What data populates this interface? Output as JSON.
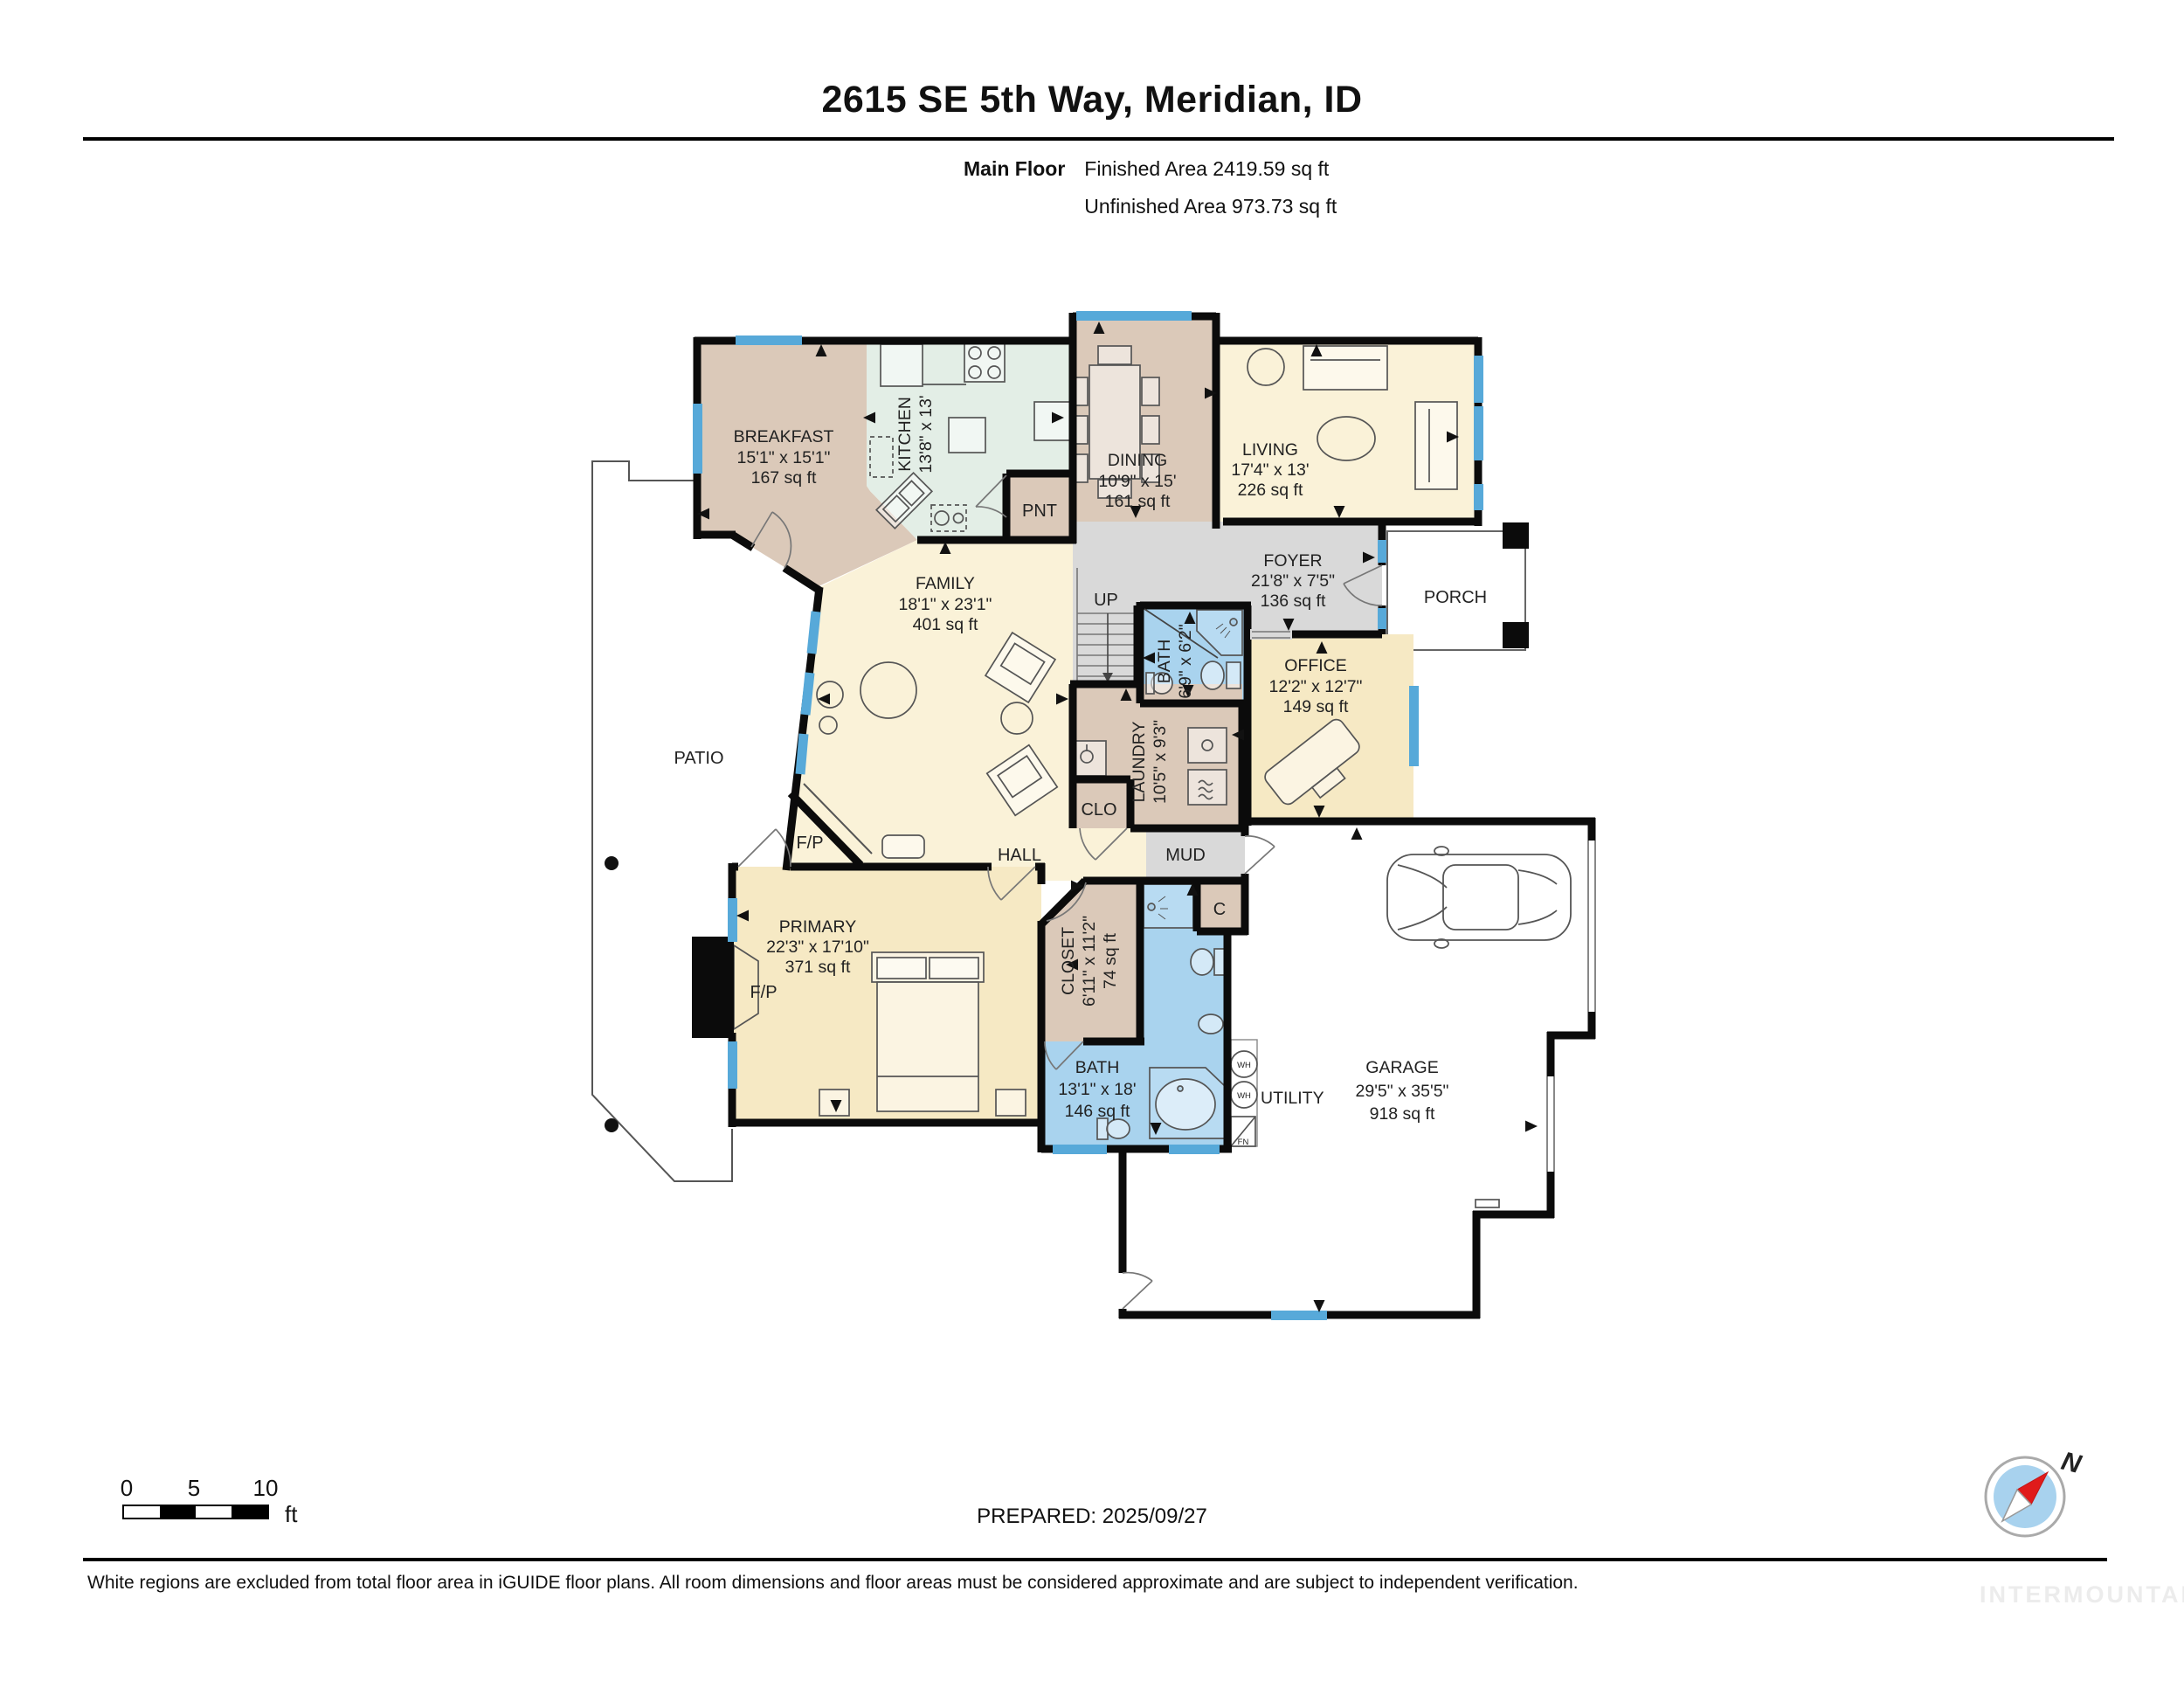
{
  "header": {
    "title": "2615 SE 5th Way, Meridian, ID",
    "floor_label": "Main Floor",
    "finished": "Finished Area 2419.59 sq ft",
    "unfinished": "Unfinished Area 973.73 sq ft"
  },
  "rooms": {
    "breakfast": {
      "name": "BREAKFAST",
      "dims": "15'1\" x 15'1\"",
      "area": "167 sq ft"
    },
    "kitchen": {
      "name": "KITCHEN",
      "dims": "13'8\" x 13'"
    },
    "pantry": {
      "name": "PNT"
    },
    "dining": {
      "name": "DINING",
      "dims": "10'9\" x 15'",
      "area": "161 sq ft"
    },
    "living": {
      "name": "LIVING",
      "dims": "17'4\" x 13'",
      "area": "226 sq ft"
    },
    "foyer": {
      "name": "FOYER",
      "dims": "21'8\" x 7'5\"",
      "area": "136 sq ft"
    },
    "porch": {
      "name": "PORCH"
    },
    "family": {
      "name": "FAMILY",
      "dims": "18'1\" x 23'1\"",
      "area": "401 sq ft"
    },
    "stairs_label": "UP",
    "half_bath": {
      "name": "BATH",
      "dims": "6'9\" x 6'2\""
    },
    "office": {
      "name": "OFFICE",
      "dims": "12'2\" x 12'7\"",
      "area": "149 sq ft"
    },
    "laundry": {
      "name": "LAUNDRY",
      "dims": "10'5\" x 9'3\""
    },
    "hall_closet": "CLO",
    "hall": "HALL",
    "mud": "MUD",
    "patio": "PATIO",
    "primary": {
      "name": "PRIMARY",
      "dims": "22'3\" x 17'10\"",
      "area": "371 sq ft"
    },
    "closet": {
      "name": "CLOSET",
      "dims": "6'11\" x 11'2\"",
      "area": "74 sq ft"
    },
    "closet_c": "C",
    "primary_bath": {
      "name": "BATH",
      "dims": "13'1\" x 18'",
      "area": "146 sq ft"
    },
    "utility": "UTILITY",
    "garage": {
      "name": "GARAGE",
      "dims": "29'5\" x 35'5\"",
      "area": "918 sq ft"
    },
    "fireplace": "F/P",
    "water_heater": "WH",
    "furnace": "FN"
  },
  "scale": {
    "n0": "0",
    "n5": "5",
    "n10": "10",
    "unit": "ft"
  },
  "compass": {
    "north": "N"
  },
  "footer": {
    "prepared": "PREPARED: 2025/09/27",
    "disclaimer": "White regions are excluded from total floor area in iGUIDE floor plans. All room dimensions and floor areas must be considered approximate and are subject to independent verification.",
    "watermark": "INTERMOUNTAIN"
  },
  "colors": {
    "tan_room": "#dbc9b9",
    "mint_room": "#e3eee6",
    "cream_room": "#faf2d8",
    "yellow_room": "#f6e9c4",
    "bath_blue": "#a9d3ee",
    "gray_room": "#d9d9d9",
    "window_blue": "#57a9d9",
    "wall": "#0b0b0b",
    "compass_red": "#e01b1b",
    "compass_blue": "#a8d2ee"
  }
}
